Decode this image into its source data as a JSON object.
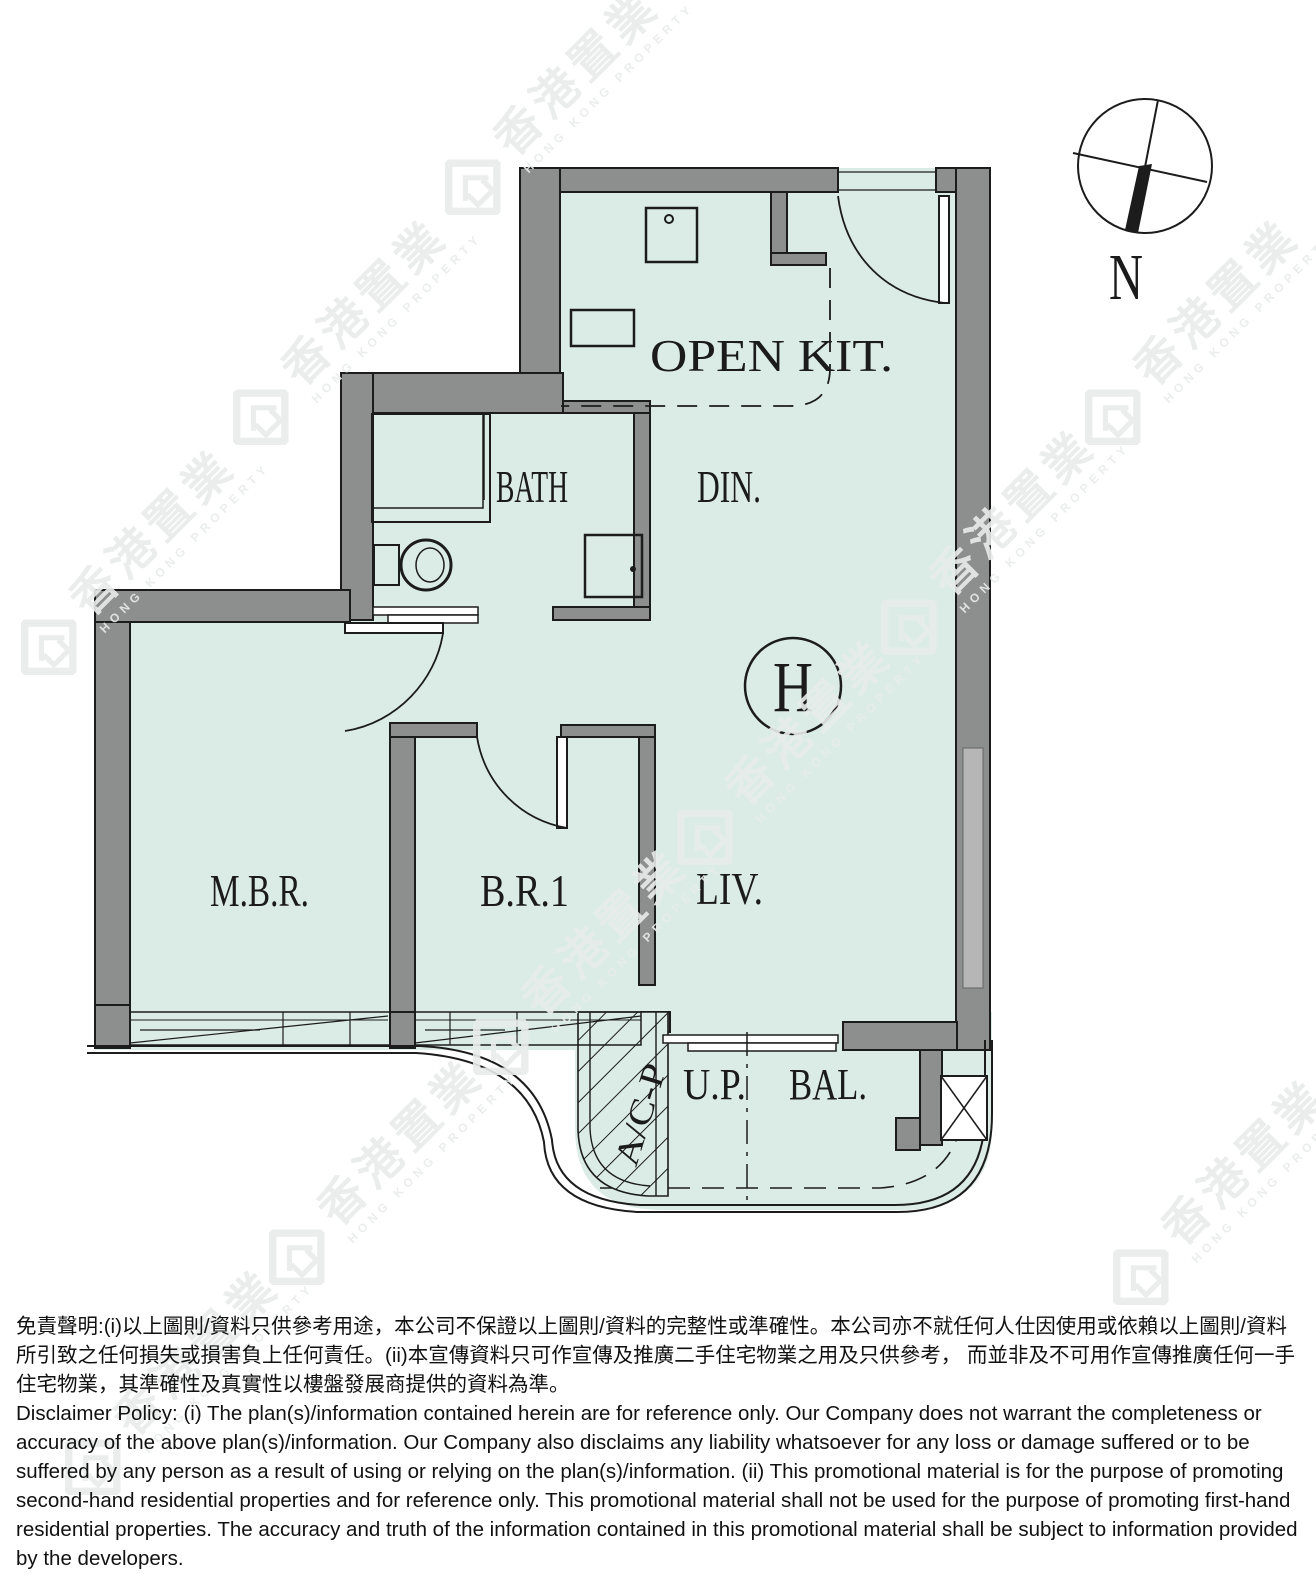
{
  "colors": {
    "floor": "#dbece6",
    "wall": "#8d8f8e",
    "line": "#1c1c1c",
    "label": "#1b1b1b",
    "watermark": "#e8eceb"
  },
  "compass": {
    "north_label": "N"
  },
  "unit": {
    "marker": "H"
  },
  "rooms": {
    "open_kitchen": "OPEN KIT.",
    "bath": "BATH",
    "dining": "DIN.",
    "master_bedroom": "M.B.R.",
    "bedroom1": "B.R.1",
    "living": "LIV.",
    "utility_platform": "U.P.",
    "balcony": "BAL.",
    "ac_platform": "A/C-P"
  },
  "watermark": {
    "zh": "香港置業",
    "en": "HONG KONG PROPERTY"
  },
  "disclaimer": {
    "zh": "免責聲明:(i)以上圖則/資料只供參考用途，本公司不保證以上圖則/資料的完整性或準確性。本公司亦不就任何人仕因使用或依賴以上圖則/資料所引致之任何損失或損害負上任何責任。(ii)本宣傳資料只可作宣傳及推廣二手住宅物業之用及只供參考， 而並非及不可用作宣傳推廣任何一手住宅物業，其準確性及真實性以樓盤發展商提供的資料為準。",
    "en": "Disclaimer Policy: (i) The plan(s)/information contained herein are for reference only. Our Company does not warrant the completeness or accuracy of the above plan(s)/information. Our Company also disclaims any liability whatsoever for any loss or damage suffered or to be suffered by any person as a result of using or relying on the plan(s)/information. (ii) This promotional material is for the purpose of promoting second-hand residential properties and for reference only. This promotional material shall not be used for the purpose of promoting first-hand residential properties. The accuracy and truth of the information contained in this promotional material shall be subject to information provided by the developers."
  }
}
